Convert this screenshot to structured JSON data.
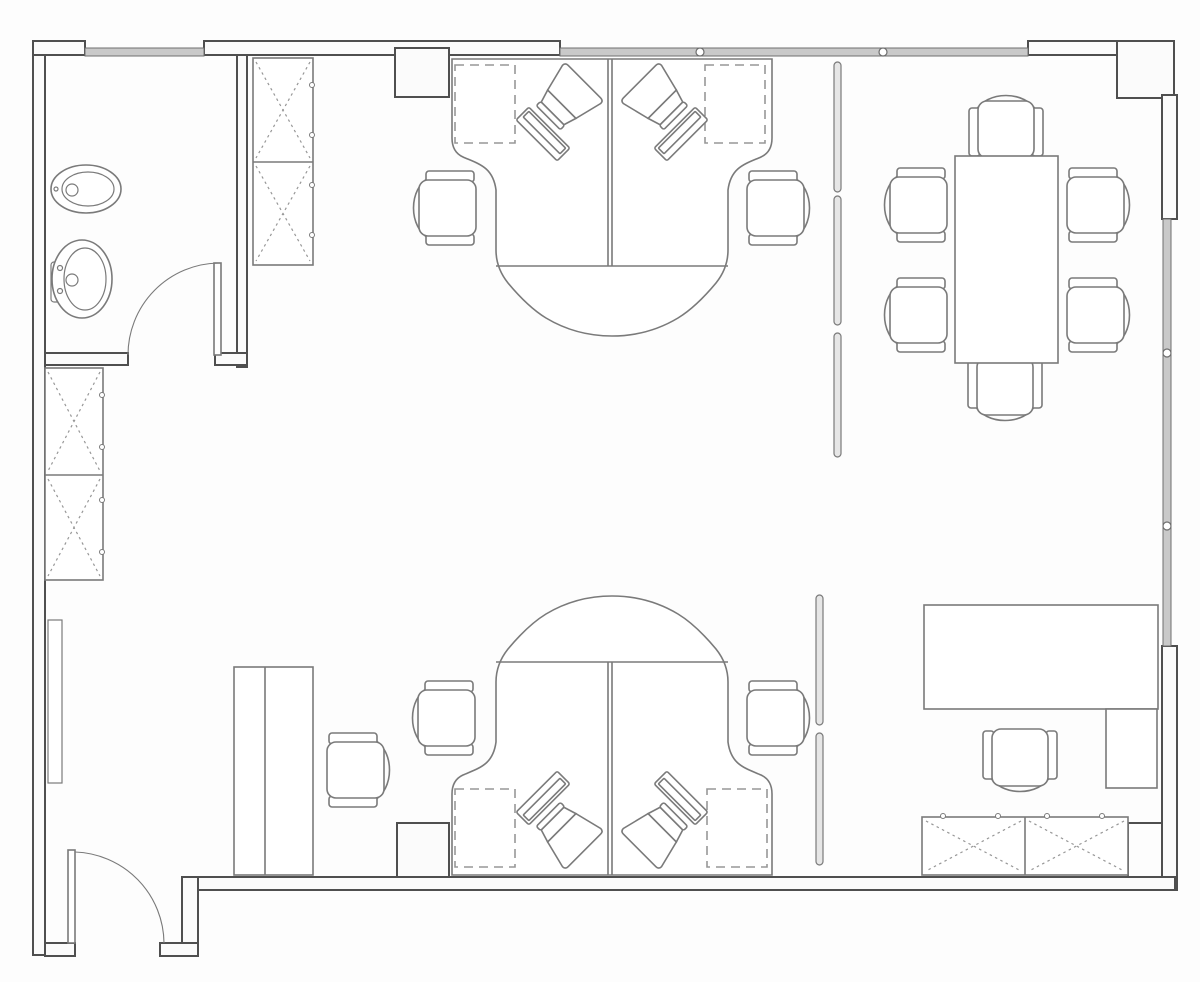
{
  "document": {
    "type": "floor-plan",
    "title": "Office floor plan",
    "visible_text": []
  },
  "palette": {
    "background": "#fdfdfd",
    "wall_line": "#4f4f4f",
    "furniture_line": "#7a7a7a",
    "dash_line": "#979797",
    "window_fill": "#c9c9c9",
    "window_line": "#6e6e6e"
  },
  "rooms": [
    {
      "name": "washroom",
      "fixtures": [
        "toilet",
        "sink",
        "swing-door"
      ]
    },
    {
      "name": "open-office",
      "fixtures": [
        "workstation-cluster-top",
        "workstation-cluster-bottom",
        "tall-cabinet",
        "side-desk",
        "radiator-panel",
        "entry-door"
      ]
    },
    {
      "name": "meeting-area",
      "fixtures": [
        "conference-table",
        "glass-partition"
      ]
    },
    {
      "name": "executive-area",
      "fixtures": [
        "executive-desk",
        "return-table",
        "credenza",
        "glass-partition"
      ]
    }
  ],
  "furniture_counts": {
    "task_chairs": 12,
    "crt_monitors": 4,
    "keyboards": 4,
    "x_marked_cabinets": 6,
    "desks": 6,
    "conference_tables": 1,
    "doors": 2,
    "window_bands": 3,
    "partition_panels": 5,
    "wall_ducts": 2
  }
}
